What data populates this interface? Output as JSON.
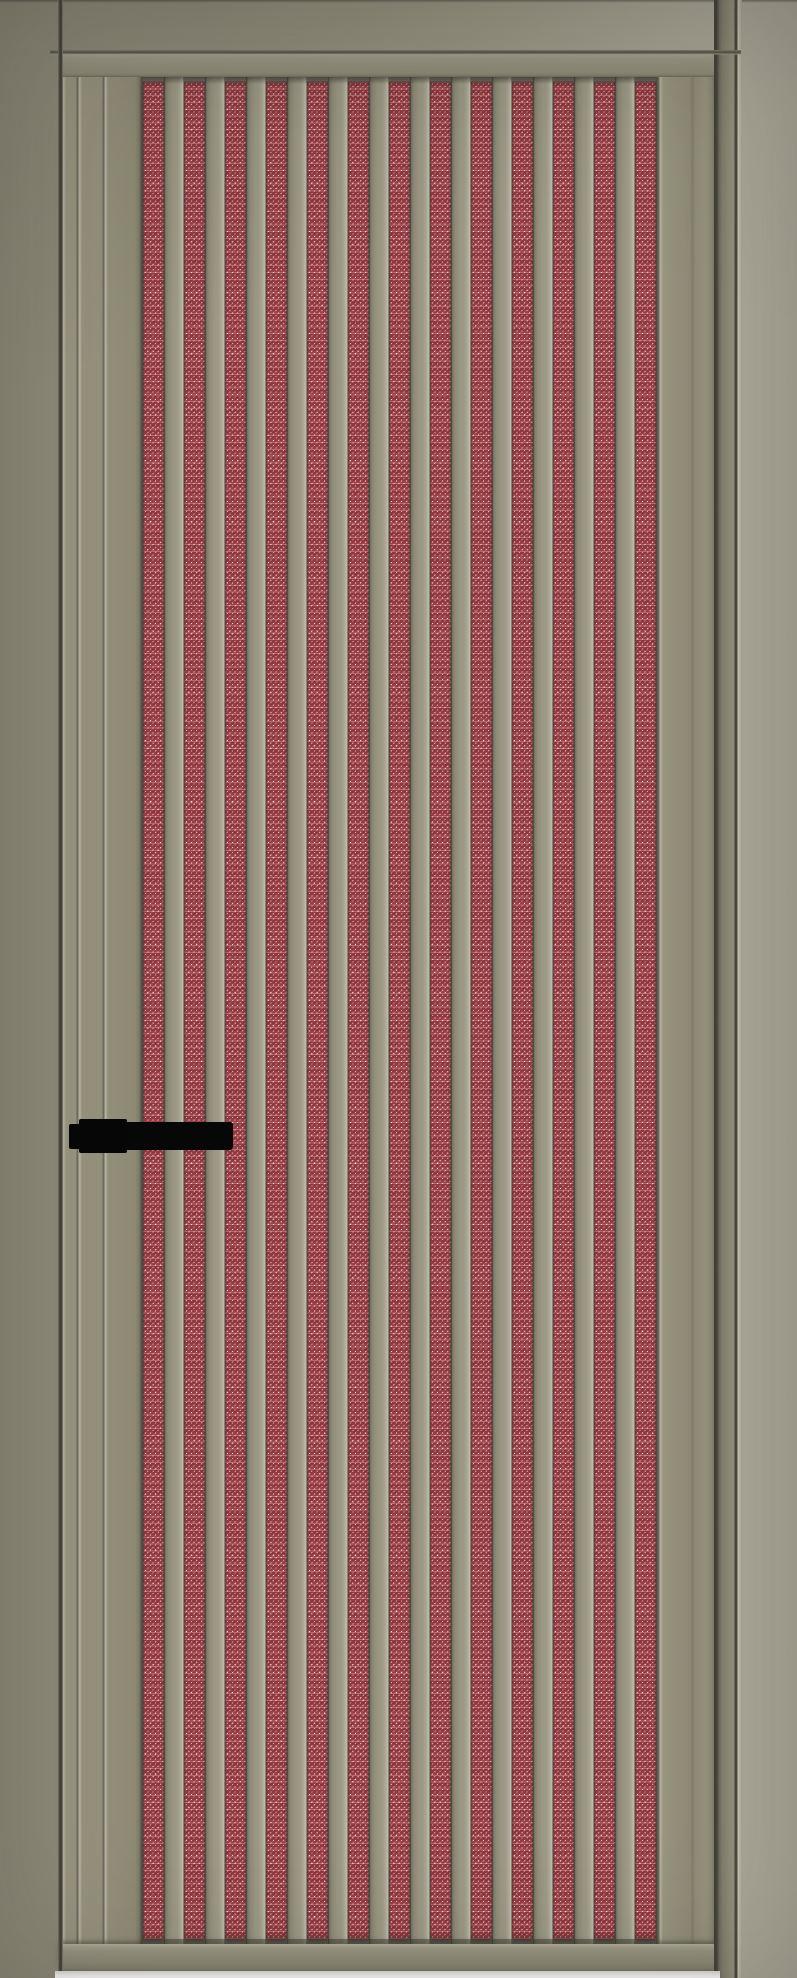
{
  "scene": {
    "subject": "full-height interior door leaf in a matching frame, vertical beige slats over a red woven metal mesh insert, black lever handle on the left",
    "handle_side": "left",
    "text_content": "none"
  },
  "door": {
    "colors": {
      "bg-left": "#8a8776",
      "bg-right": "#aaa798",
      "line-dark": "#45443c",
      "stile-shadow": "#6e6b5d",
      "rail": "#93907d",
      "rail-dark": "#6f6d60",
      "slat": "#9a9683",
      "slat-edge-light": "#bcb9a7",
      "slat-edge-dark": "#6b685a",
      "mesh-red": "#a8444b",
      "mesh-red-deep": "#8e353d",
      "mesh-light": "#eddfdb",
      "handle": "#070707",
      "floor-strip": "#f1f1ee"
    },
    "mesh": {
      "stripe_count": 13,
      "stripe_width_px": 21,
      "pitch_px": 41,
      "panel_left_px": 143,
      "panel_top_px": 77,
      "stripe_top_px": 82,
      "stripe_bottom_px": 1939
    },
    "handle": {
      "x_px": 69,
      "y_px": 1119,
      "length_px": 164,
      "height_px": 34
    }
  }
}
